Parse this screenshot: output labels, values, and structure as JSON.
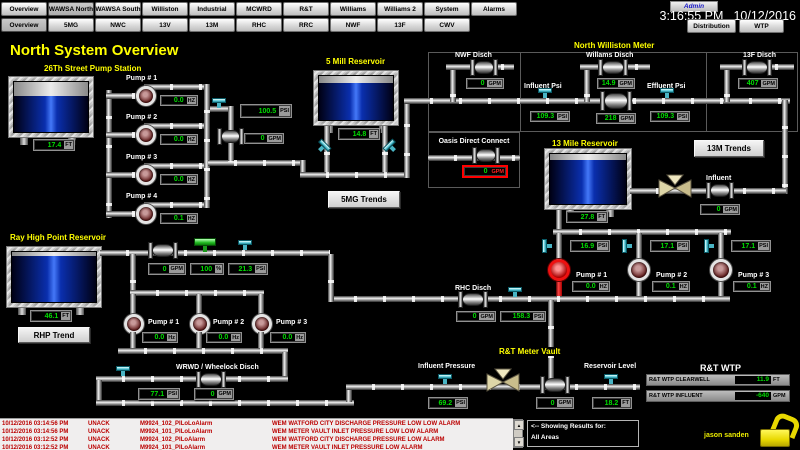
{
  "header": {
    "admin": "Admin",
    "time": "3:16:55 PM",
    "date": "10/12/2016",
    "row1": [
      "Overview",
      "WAWSA North",
      "WAWSA South",
      "Williston",
      "Industrial",
      "MCWRD",
      "R&T",
      "Williams",
      "Williams 2",
      "System",
      "Alarms"
    ],
    "row2": [
      "Overview",
      "5MG",
      "NWC",
      "13V",
      "13M",
      "RHC",
      "RRC",
      "NWF",
      "13F",
      "CWV"
    ],
    "distribution": "Distribution",
    "wtp": "WTP"
  },
  "title": "North System Overview",
  "s26": {
    "title": "26Th Street Pump Station",
    "level": {
      "value": "17.4",
      "unit": "FT",
      "fill": 72
    },
    "pumps": [
      {
        "label": "Pump # 1",
        "value": "0.0",
        "unit": "HZ"
      },
      {
        "label": "Pump # 2",
        "value": "0.0",
        "unit": "HZ"
      },
      {
        "label": "Pump # 3",
        "value": "0.0",
        "unit": "HZ"
      },
      {
        "label": "Pump # 4",
        "value": "0.1",
        "unit": "HZ"
      }
    ],
    "psi": {
      "value": "100.5",
      "unit": "PSI"
    },
    "gpm": {
      "value": "0",
      "unit": "GPM"
    }
  },
  "mill5": {
    "title": "5 Mill Reservoir",
    "level": {
      "value": "14.8",
      "unit": "FT",
      "fill": 84
    },
    "trends_btn": "5MG Trends"
  },
  "nwm": {
    "title": "North Williston Meter",
    "nwf": {
      "label": "NWF Disch",
      "value": "0",
      "unit": "GPM"
    },
    "willams": {
      "label": "Willams Disch",
      "value": "14.9",
      "unit": "GPM"
    },
    "influent": {
      "label": "Influent Psi",
      "value": "109.3",
      "unit": "PSI"
    },
    "flow": {
      "value": "218",
      "unit": "GPM"
    },
    "effluent": {
      "label": "Effluent Psi",
      "value": "109.3",
      "unit": "PSI"
    },
    "f13": {
      "label": "13F Disch",
      "value": "407",
      "unit": "GPM"
    }
  },
  "oasis": {
    "label": "Oasis Direct Connect",
    "value": "0",
    "unit": "GPM"
  },
  "m13": {
    "title": "13 Mile Reservoir",
    "trends_btn": "13M Trends",
    "level": {
      "value": "27.8",
      "unit": "FT",
      "fill": 88
    },
    "influent": {
      "label": "Influent",
      "value": "0",
      "unit": "GPM"
    },
    "psis": [
      {
        "value": "16.9",
        "unit": "PSI"
      },
      {
        "value": "17.1",
        "unit": "PSI"
      },
      {
        "value": "17.1",
        "unit": "PSI"
      }
    ],
    "pumps": [
      {
        "label": "Pump # 1",
        "value": "0.0",
        "unit": "HZ"
      },
      {
        "label": "Pump # 2",
        "value": "0.1",
        "unit": "HZ"
      },
      {
        "label": "Pump # 3",
        "value": "0.1",
        "unit": "HZ"
      }
    ]
  },
  "rhp": {
    "title": "Ray High Point Reservoir",
    "trend_btn": "RHP Trend",
    "level": {
      "value": "46.1",
      "unit": "FT",
      "fill": 92
    },
    "line": [
      {
        "value": "0",
        "unit": "GPM"
      },
      {
        "value": "100",
        "unit": "%"
      },
      {
        "value": "21.3",
        "unit": "PSI"
      }
    ],
    "pumps": [
      {
        "label": "Pump # 1",
        "value": "0.0",
        "unit": "Hz"
      },
      {
        "label": "Pump # 2",
        "value": "0.0",
        "unit": "Hz"
      },
      {
        "label": "Pump # 3",
        "value": "0.0",
        "unit": "Hz"
      }
    ]
  },
  "wrwd": {
    "label": "WRWD / Wheelock Disch",
    "psi": {
      "value": "77.1",
      "unit": "PSI"
    },
    "gpm": {
      "value": "0",
      "unit": "GPM"
    }
  },
  "rhc": {
    "label": "RHC Disch",
    "gpm": {
      "value": "0",
      "unit": "GPM"
    },
    "psi": {
      "value": "158.3",
      "unit": "PSI"
    }
  },
  "rtv": {
    "title": "R&T Meter Vault",
    "influent": {
      "label": "Influent Pressure",
      "value": "69.2",
      "unit": "PSI"
    },
    "flow": {
      "value": "0",
      "unit": "GPM"
    },
    "reservoir": {
      "label": "Reservoir Level",
      "value": "18.2",
      "unit": "FT"
    }
  },
  "rtwtp": {
    "title": "R&T WTP",
    "rows": [
      {
        "label": "R&T WTP CLEARWELL",
        "value": "11.9",
        "unit": "FT"
      },
      {
        "label": "R&T WTP INFLUENT",
        "value": "-640",
        "unit": "GPM"
      }
    ]
  },
  "alarmbar": {
    "rows": [
      {
        "time": "10/12/2016 03:14:56 PM",
        "ack": "UNACK",
        "tag": "M9924_102_PILoLoAlarm",
        "msg": "WEM WATFORD CITY DISCHARGE PRESSURE LOW LOW ALARM"
      },
      {
        "time": "10/12/2016 03:14:56 PM",
        "ack": "UNACK",
        "tag": "M9924_101_PILoLoAlarm",
        "msg": "WEM METER VAULT INLET PRESSURE LOW LOW ALARM"
      },
      {
        "time": "10/12/2016 03:12:52 PM",
        "ack": "UNACK",
        "tag": "M9924_102_PILoAlarm",
        "msg": "WEM WATFORD CITY DISCHARGE PRESSURE LOW ALARM"
      },
      {
        "time": "10/12/2016 03:12:52 PM",
        "ack": "UNACK",
        "tag": "M9924_101_PILoAlarm",
        "msg": "WEM METER VAULT INLET PRESSURE LOW ALARM"
      }
    ],
    "showing1": "<-- Showing Results for:",
    "showing2": "All Areas",
    "user": "jason sanden"
  }
}
